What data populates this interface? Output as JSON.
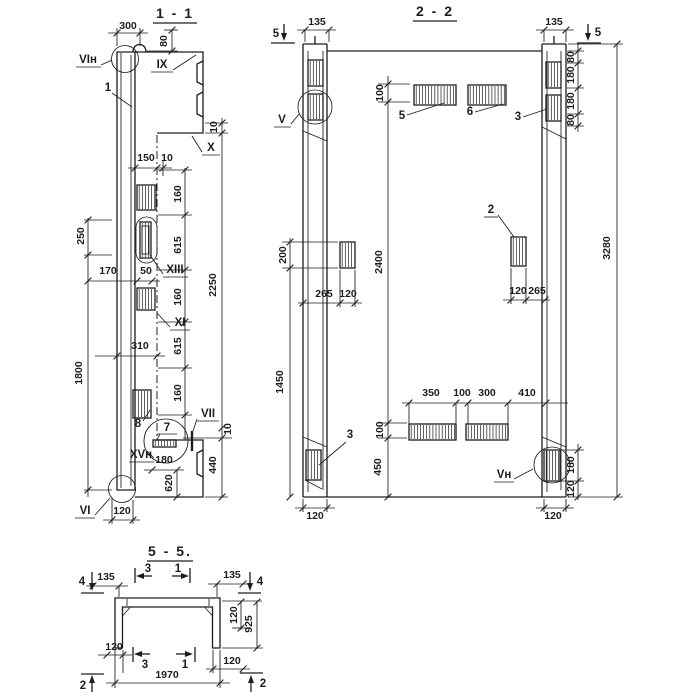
{
  "s11": {
    "title": "1 - 1",
    "labels": {
      "vi_top": "VIн",
      "item1": "1",
      "ix": "IX",
      "x": "X",
      "xiii": "XIII",
      "xi": "XI",
      "item8": "8",
      "item7": "7",
      "vii": "VII",
      "xv": "XVн",
      "vi_bottom": "VI"
    },
    "dims": {
      "d300": "300",
      "d80": "80",
      "d10_top": "10",
      "d150": "150",
      "d10_mid": "10",
      "d160_1": "160",
      "d615_1": "615",
      "d160_2": "160",
      "d615_2": "615",
      "d160_3": "160",
      "d2250": "2250",
      "d250": "250",
      "d170": "170",
      "d50": "50",
      "d310": "310",
      "d1800": "1800",
      "d10_bot": "10",
      "d440": "440",
      "d180": "180",
      "d620": "620",
      "d120": "120"
    }
  },
  "s22": {
    "title": "2 - 2",
    "markers": {
      "m5_left": "5",
      "m5_right": "5"
    },
    "labels": {
      "v": "V",
      "item5": "5",
      "item6": "6",
      "item3_top": "3",
      "item2": "2",
      "item3_bottom": "3",
      "v_bottom": "Vн"
    },
    "dims": {
      "d135_left": "135",
      "d135_right": "135",
      "d80_1": "80",
      "d180_1": "180",
      "d180_2": "180",
      "d80_2": "80",
      "d100_top": "100",
      "d2400": "2400",
      "d200": "200",
      "d1450": "1450",
      "d265_left": "265",
      "d120_left": "120",
      "d120_right": "120",
      "d265_right": "265",
      "d3280": "3280",
      "d350": "350",
      "d100_mid": "100",
      "d300": "300",
      "d410": "410",
      "d100_bot": "100",
      "d450": "450",
      "d180_right": "180",
      "d120_chain": "120",
      "d120_col_left": "120",
      "d120_col_right": "120"
    }
  },
  "s55": {
    "title": "5 - 5.",
    "markers": {
      "m4_left": "4",
      "m4_right": "4",
      "m3_top": "3",
      "m1_top": "1",
      "m3_bottom": "3",
      "m1_bottom": "1",
      "m2_left": "2",
      "m2_right": "2"
    },
    "dims": {
      "d135_left": "135",
      "d135_right": "135",
      "d120_flange": "120",
      "d925": "925",
      "d120_bl": "120",
      "d120_br": "120",
      "d1970": "1970"
    }
  }
}
